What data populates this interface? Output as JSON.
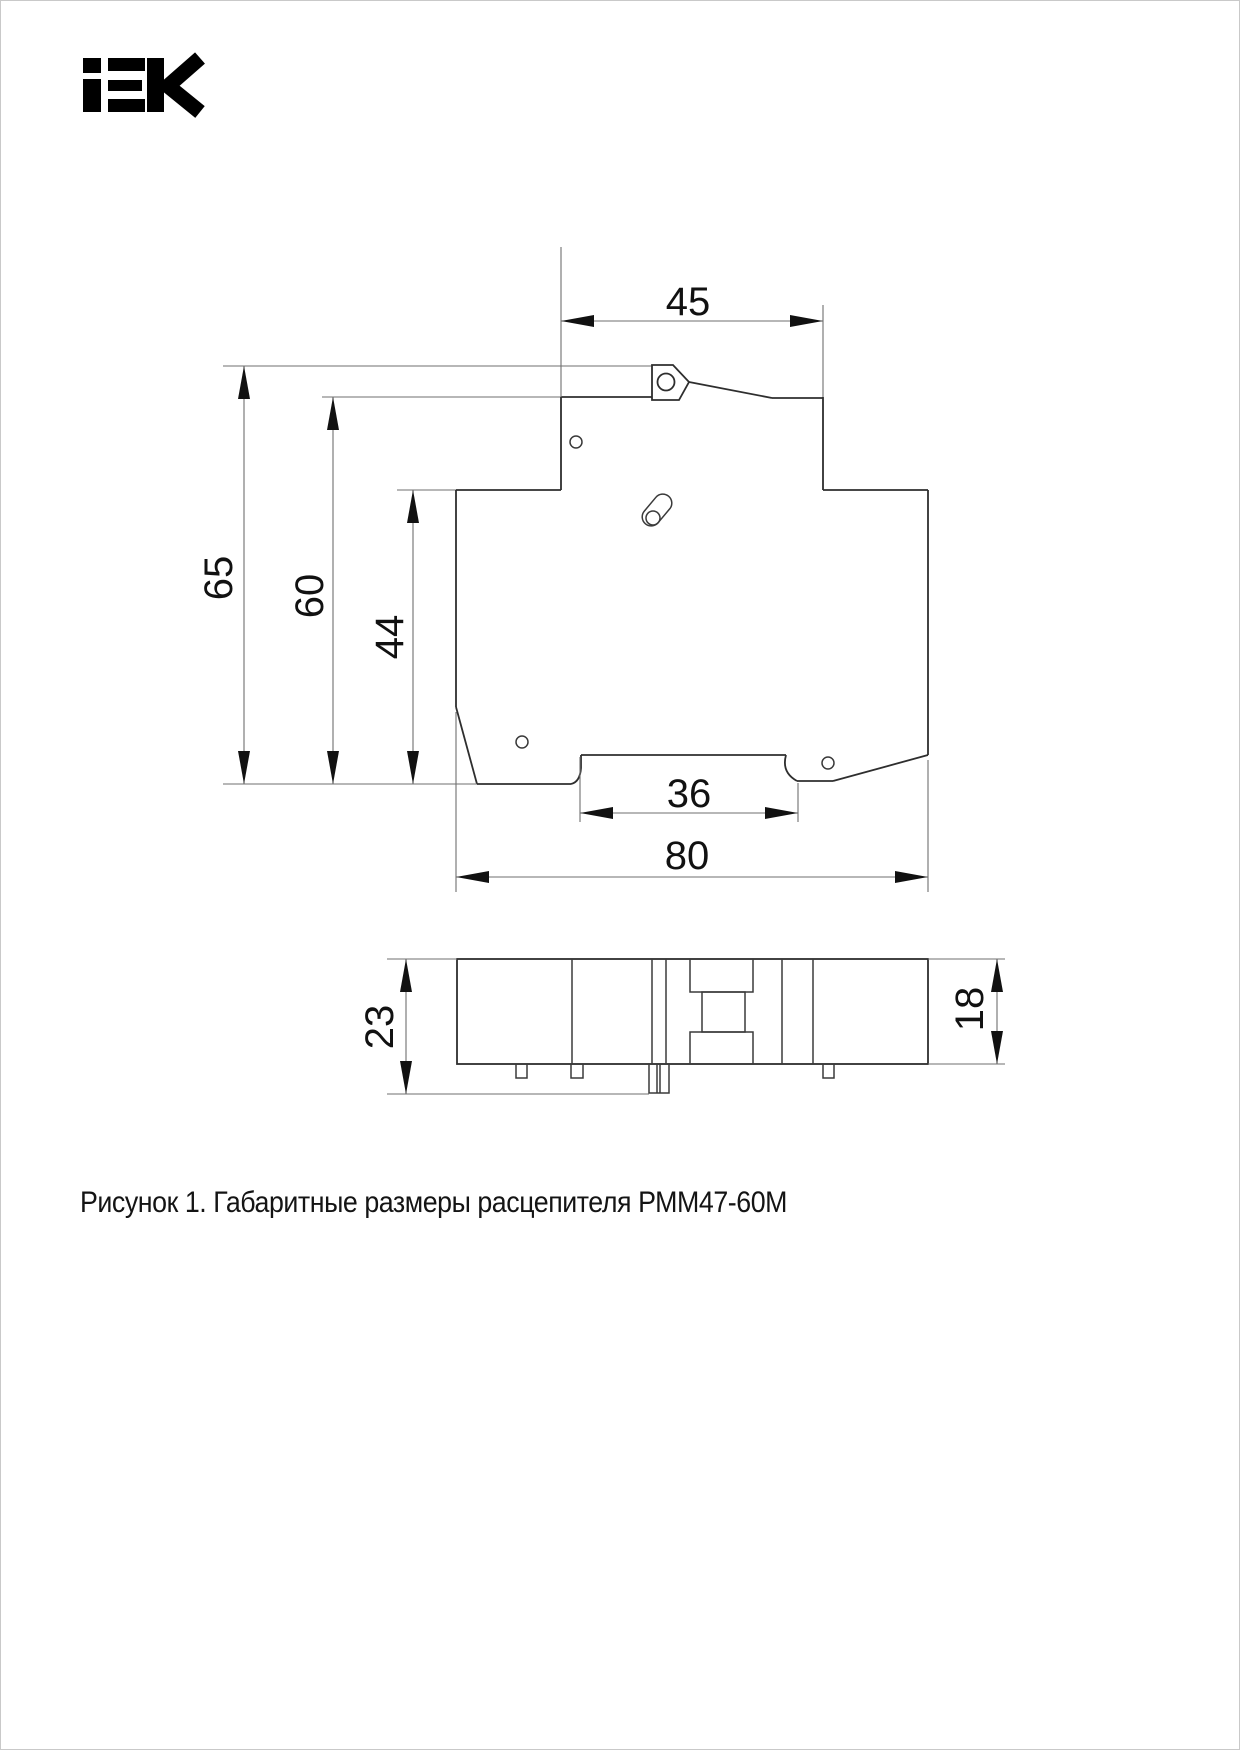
{
  "page": {
    "width": 1240,
    "height": 1750,
    "background": "#ffffff",
    "border_color": "#c9c9c9"
  },
  "logo": {
    "brand": "IEK",
    "color": "#000000"
  },
  "figure": {
    "caption": "Рисунок 1. Габаритные размеры расцепителя РММ47-60М",
    "product": "РММ47-60М",
    "figure_number": "Рисунок 1",
    "dims": {
      "front": {
        "top_width": "45",
        "height_total": "65",
        "height_front": "60",
        "height_body": "44",
        "recess_width": "36",
        "base_width": "80"
      },
      "side": {
        "height": "23",
        "body_height": "18"
      }
    },
    "line_colors": {
      "outline": "#2e2e2e",
      "thin": "#6f6f6f",
      "text": "#111111"
    }
  }
}
